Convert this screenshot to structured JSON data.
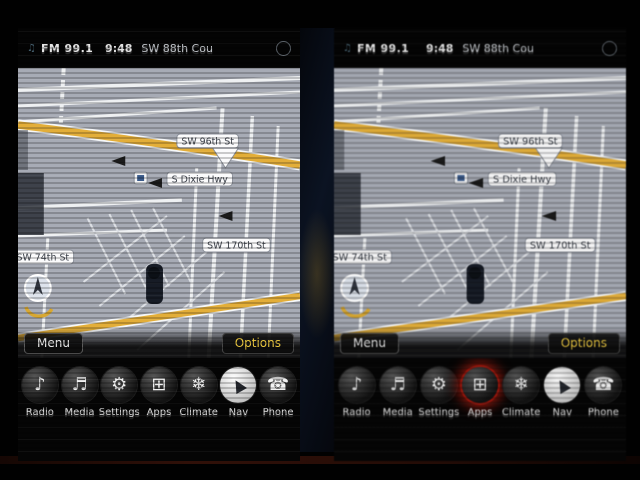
{
  "status_bar": {
    "source": "FM 99.1",
    "time": "9:48",
    "current_street": "SW 88th Cou",
    "right_icon": "temp-indicator"
  },
  "map": {
    "labels": {
      "street_96": "SW 96th St",
      "dixie": "S Dixie Hwy",
      "street_170": "SW 170th St",
      "street_74": "SW 74th St"
    }
  },
  "nav_bar": {
    "menu": "Menu",
    "options": "Options"
  },
  "dock": {
    "items": [
      {
        "label": "Radio",
        "icon": "radio-icon",
        "glyph": "♪"
      },
      {
        "label": "Media",
        "icon": "media-icon",
        "glyph": "♬"
      },
      {
        "label": "Settings",
        "icon": "settings-icon",
        "glyph": "⚙"
      },
      {
        "label": "Apps",
        "icon": "apps-icon",
        "glyph": "⊞"
      },
      {
        "label": "Climate",
        "icon": "climate-icon",
        "glyph": "❄"
      },
      {
        "label": "Nav",
        "icon": "nav-icon",
        "glyph": "▲"
      },
      {
        "label": "Phone",
        "icon": "phone-icon",
        "glyph": "☎"
      }
    ]
  },
  "colors": {
    "map_base": "#a7abb5",
    "road_major": "#e3ae39",
    "options_text": "#e9c63f",
    "apps_glow": "#c41e14"
  }
}
